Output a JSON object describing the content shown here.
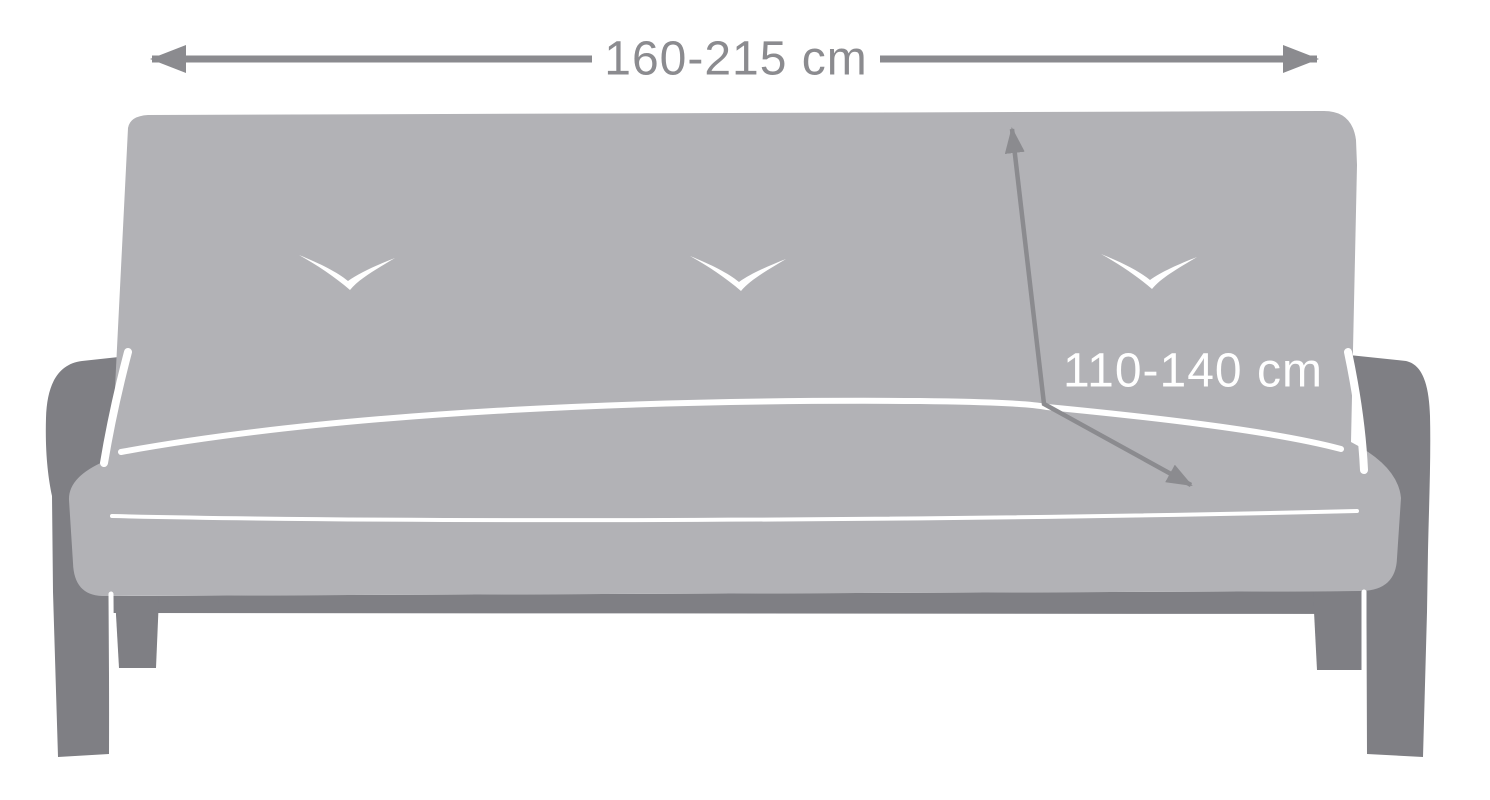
{
  "diagram": {
    "type": "sofa-cover-dimension-diagram",
    "labels": {
      "width": "160-215 cm",
      "depth": "110-140 cm"
    },
    "seam_marks_count": 3,
    "colors": {
      "background": "#ffffff",
      "body": "#b2b2b6",
      "frame": "#7f7f84",
      "dimension": "#8b8b8f",
      "detail": "#ffffff"
    }
  }
}
